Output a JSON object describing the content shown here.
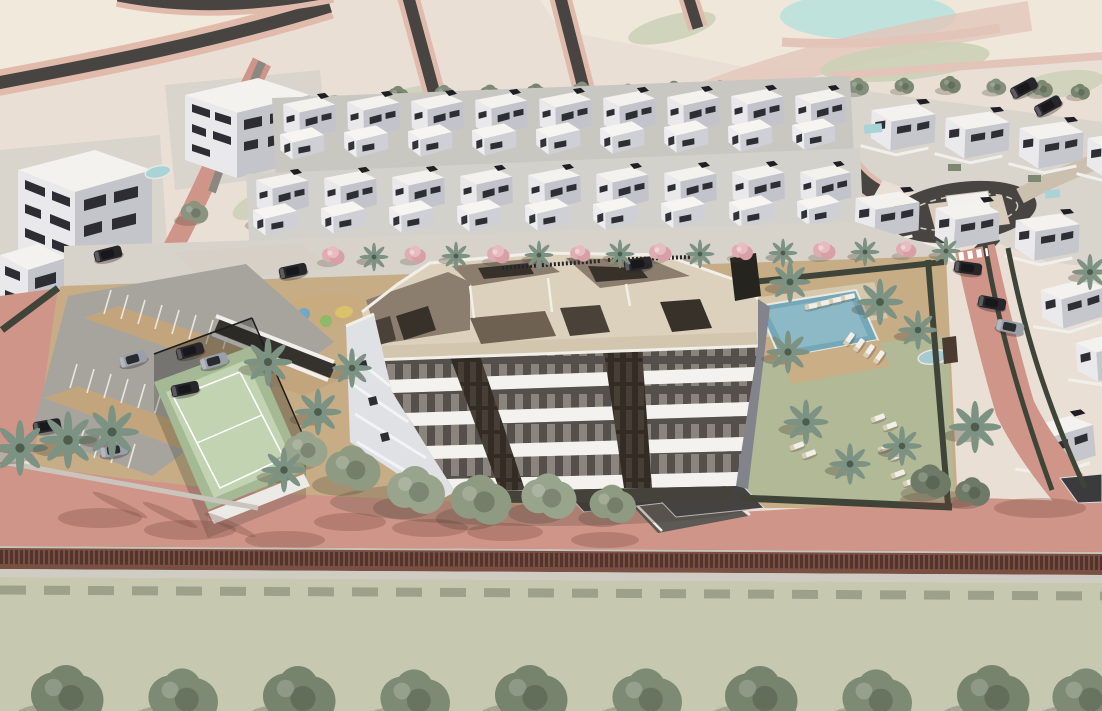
{
  "scene": {
    "type": "architectural-aerial-render",
    "description": "Aerial 3D visualization of a residential development: a central five-storey apartment building with rooftop terraces, surrounded by rows of white townhouses and villas, a communal pool garden with palm trees and sun loungers, a paddle-tennis court, a playground, a surface parking lot with cars, perimeter roads, a roundabout with a monument, farmland in the background and a green field with a row of trees in the foreground.",
    "areas": [
      {
        "name": "background-farmland",
        "label": "terraced farmland with rural roads"
      },
      {
        "name": "townhouse-rows",
        "label": "two rows of white townhouses"
      },
      {
        "name": "villa-cluster",
        "label": "detached villas with private pools"
      },
      {
        "name": "roundabout",
        "label": "roundabout with white monument block"
      },
      {
        "name": "main-building",
        "label": "five-storey apartment block with roof terraces"
      },
      {
        "name": "pool-garden",
        "label": "communal pool, deck and lawn with loungers"
      },
      {
        "name": "tennis-court",
        "label": "fenced paddle court"
      },
      {
        "name": "playground",
        "label": "children playground with colored circles"
      },
      {
        "name": "parking-lot",
        "label": "surface parking with cars"
      },
      {
        "name": "front-road",
        "label": "salmon perimeter road"
      },
      {
        "name": "front-field",
        "label": "green field with tree row"
      }
    ]
  },
  "colors": {
    "field_beige": "#e9dfd5",
    "field_cream": "#f2e9dd",
    "field_pink": "#e3c4b8",
    "field_sage": "#cbd0b6",
    "water": "#bfe2dc",
    "road_dark": "#474441",
    "road_gray": "#8b8781",
    "salmon": "#cf9588",
    "salmon_light": "#e0bbac",
    "sidewalk": "#d8d3ca",
    "cobble": "#d6d0c6",
    "ground_tan": "#c6ad86",
    "aisle_tan": "#c2a57c",
    "parking_gray": "#a7a49e",
    "bottom_field": "#c6c9b0",
    "wall_brown": "#7a4f44",
    "coping": "#cfccc4",
    "paving_pale": "#d9d5cd",
    "lawn": "#b2b996",
    "court": "#c1d3b1",
    "court_border": "#a5b995",
    "pool": "#74a7b8",
    "pool_light": "#a6cad2",
    "deck": "#c9ae86",
    "white_hi": "#f3f2ef",
    "white_lo": "#e9e9ec",
    "gray_side": "#c4c5cb",
    "gray_side2": "#9b9ca4",
    "win": "#2d2d33",
    "roof_beige": "#dcd1bc",
    "roof_beige2": "#d2c6ae",
    "taupe": "#8b7e6f",
    "taupe_dark": "#6e6152",
    "brown_core": "#38312a",
    "win_row_bg": "#55504b",
    "win_slit": "#8a847c",
    "core_bg": "#332c25",
    "core_slit": "#473f36",
    "hedge": "#3e4438",
    "tree": "#8a9480",
    "tree_light": "#99a48c",
    "tree_dark": "#707d67",
    "palm": "#7c9282",
    "pink": "#dfacb0",
    "car_dark": "#26262b",
    "car_silver": "#9aa0a8",
    "lounger": "#f1efe8",
    "plinth": "#45413b",
    "side_face": "#83838b",
    "band1": "#c9c7c2",
    "band2": "#d3d1cc",
    "driveway": "#5d5954",
    "pergola": "#3b3b3d"
  },
  "instances": [
    {
      "l": "otrees",
      "t": "tree",
      "x": 398,
      "y": 96,
      "s": 0.72,
      "c": "#7c8872"
    },
    {
      "l": "otrees",
      "t": "tree",
      "x": 444,
      "y": 94,
      "s": 0.66,
      "c": "#83907b"
    },
    {
      "l": "otrees",
      "t": "tree",
      "x": 490,
      "y": 95,
      "s": 0.74,
      "c": "#7c8872"
    },
    {
      "l": "otrees",
      "t": "tree",
      "x": 536,
      "y": 93,
      "s": 0.68,
      "c": "#76836d"
    },
    {
      "l": "otrees",
      "t": "tree",
      "x": 582,
      "y": 92,
      "s": 0.75,
      "c": "#83907b"
    },
    {
      "l": "otrees",
      "t": "tree",
      "x": 628,
      "y": 93,
      "s": 0.67,
      "c": "#7c8872"
    },
    {
      "l": "otrees",
      "t": "tree",
      "x": 674,
      "y": 91,
      "s": 0.73,
      "c": "#76836d"
    },
    {
      "l": "otrees",
      "t": "tree",
      "x": 720,
      "y": 90,
      "s": 0.69,
      "c": "#83907b"
    },
    {
      "l": "otrees",
      "t": "tree",
      "x": 766,
      "y": 91,
      "s": 0.74,
      "c": "#7c8872"
    },
    {
      "l": "otrees",
      "t": "tree",
      "x": 812,
      "y": 89,
      "s": 0.68,
      "c": "#76836d"
    },
    {
      "l": "otrees",
      "t": "tree",
      "x": 858,
      "y": 88,
      "s": 0.73,
      "c": "#83907b"
    },
    {
      "l": "otrees",
      "t": "tree",
      "x": 904,
      "y": 87,
      "s": 0.67,
      "c": "#7c8872"
    },
    {
      "l": "otrees",
      "t": "tree",
      "x": 950,
      "y": 86,
      "s": 0.72,
      "c": "#76836d"
    },
    {
      "l": "otrees",
      "t": "tree",
      "x": 996,
      "y": 88,
      "s": 0.68,
      "c": "#83907b"
    },
    {
      "l": "otrees",
      "t": "tree",
      "x": 1042,
      "y": 90,
      "s": 0.72,
      "c": "#7c8872"
    },
    {
      "l": "otrees",
      "t": "tree",
      "x": 1080,
      "y": 93,
      "s": 0.66,
      "c": "#76836d"
    },
    {
      "l": "floraL",
      "t": "tree",
      "x": 335,
      "y": 114,
      "s": 1.35,
      "c": "#8a9480",
      "n": "tree"
    },
    {
      "l": "floraL",
      "t": "tree",
      "x": 268,
      "y": 218,
      "s": 1.1,
      "c": "#7f8a76",
      "n": "tree"
    },
    {
      "l": "floraL",
      "t": "tree",
      "x": 194,
      "y": 214,
      "s": 0.95,
      "c": "#8a9480",
      "n": "tree"
    },
    {
      "l": "flora",
      "t": "pink",
      "x": 333,
      "y": 257,
      "s": 1.0,
      "n": "flowering-tree"
    },
    {
      "l": "flora",
      "t": "pink",
      "x": 415,
      "y": 256,
      "s": 0.95,
      "n": "flowering-tree"
    },
    {
      "l": "flora",
      "t": "pink",
      "x": 498,
      "y": 256,
      "s": 1.0,
      "n": "flowering-tree"
    },
    {
      "l": "flora",
      "t": "pink",
      "x": 580,
      "y": 255,
      "s": 0.9,
      "n": "flowering-tree"
    },
    {
      "l": "flora",
      "t": "pink",
      "x": 660,
      "y": 254,
      "s": 1.0,
      "n": "flowering-tree"
    },
    {
      "l": "flora",
      "t": "pink",
      "x": 742,
      "y": 253,
      "s": 0.95,
      "n": "flowering-tree"
    },
    {
      "l": "flora",
      "t": "pink",
      "x": 824,
      "y": 252,
      "s": 1.0,
      "n": "flowering-tree"
    },
    {
      "l": "flora",
      "t": "pink",
      "x": 906,
      "y": 251,
      "s": 0.9,
      "n": "flowering-tree"
    },
    {
      "l": "flora",
      "t": "palm",
      "x": 374,
      "y": 257,
      "s": 0.8,
      "n": "palm-tree"
    },
    {
      "l": "flora",
      "t": "palm",
      "x": 456,
      "y": 256,
      "s": 0.8,
      "n": "palm-tree"
    },
    {
      "l": "flora",
      "t": "palm",
      "x": 539,
      "y": 255,
      "s": 0.8,
      "n": "palm-tree"
    },
    {
      "l": "flora",
      "t": "palm",
      "x": 620,
      "y": 254,
      "s": 0.8,
      "n": "palm-tree"
    },
    {
      "l": "flora",
      "t": "palm",
      "x": 700,
      "y": 254,
      "s": 0.8,
      "n": "palm-tree"
    },
    {
      "l": "flora",
      "t": "palm",
      "x": 783,
      "y": 253,
      "s": 0.8,
      "n": "palm-tree"
    },
    {
      "l": "flora",
      "t": "palm",
      "x": 865,
      "y": 252,
      "s": 0.8,
      "n": "palm-tree"
    },
    {
      "l": "flora",
      "t": "palm",
      "x": 946,
      "y": 251,
      "s": 0.8,
      "n": "palm-tree"
    },
    {
      "l": "flora",
      "t": "tree",
      "x": 305,
      "y": 452,
      "s": 1.5,
      "c": "#99a48c",
      "n": "tree"
    },
    {
      "l": "flora",
      "t": "tree",
      "x": 352,
      "y": 472,
      "s": 1.9,
      "c": "#8e9a81",
      "n": "tree"
    },
    {
      "l": "flora",
      "t": "tree",
      "x": 415,
      "y": 494,
      "s": 2.0,
      "c": "#99a48c",
      "n": "tree"
    },
    {
      "l": "flora",
      "t": "tree",
      "x": 480,
      "y": 504,
      "s": 2.1,
      "c": "#8e9a81",
      "n": "tree"
    },
    {
      "l": "flora",
      "t": "tree",
      "x": 548,
      "y": 500,
      "s": 1.9,
      "c": "#99a48c",
      "n": "tree"
    },
    {
      "l": "flora",
      "t": "tree",
      "x": 612,
      "y": 507,
      "s": 1.6,
      "c": "#8e9a81",
      "n": "tree"
    },
    {
      "l": "flora",
      "t": "tree",
      "x": 930,
      "y": 484,
      "s": 1.4,
      "c": "#6e7a66",
      "n": "tree"
    },
    {
      "l": "flora",
      "t": "tree",
      "x": 972,
      "y": 494,
      "s": 1.2,
      "c": "#6e7a66",
      "n": "tree"
    },
    {
      "l": "flora",
      "t": "palm",
      "x": 20,
      "y": 448,
      "s": 1.55,
      "n": "palm-tree"
    },
    {
      "l": "flora",
      "t": "palm",
      "x": 68,
      "y": 440,
      "s": 1.6,
      "n": "palm-tree"
    },
    {
      "l": "flora",
      "t": "palm",
      "x": 112,
      "y": 432,
      "s": 1.5,
      "n": "palm-tree"
    },
    {
      "l": "flora",
      "t": "palm",
      "x": 268,
      "y": 362,
      "s": 1.35,
      "n": "palm-tree"
    },
    {
      "l": "flora",
      "t": "palm",
      "x": 318,
      "y": 412,
      "s": 1.3,
      "n": "palm-tree"
    },
    {
      "l": "flora",
      "t": "palm",
      "x": 284,
      "y": 470,
      "s": 1.25,
      "n": "palm-tree"
    },
    {
      "l": "flora",
      "t": "palm",
      "x": 352,
      "y": 368,
      "s": 1.1,
      "n": "palm-tree"
    },
    {
      "l": "flora",
      "t": "palm",
      "x": 790,
      "y": 282,
      "s": 1.15,
      "n": "palm-tree"
    },
    {
      "l": "flora",
      "t": "palm",
      "x": 880,
      "y": 302,
      "s": 1.3,
      "n": "palm-tree"
    },
    {
      "l": "flora",
      "t": "palm",
      "x": 918,
      "y": 330,
      "s": 1.1,
      "n": "palm-tree"
    },
    {
      "l": "flora",
      "t": "palm",
      "x": 788,
      "y": 352,
      "s": 1.2,
      "n": "palm-tree"
    },
    {
      "l": "flora",
      "t": "palm",
      "x": 806,
      "y": 422,
      "s": 1.25,
      "n": "palm-tree"
    },
    {
      "l": "flora",
      "t": "palm",
      "x": 850,
      "y": 464,
      "s": 1.15,
      "n": "palm-tree"
    },
    {
      "l": "flora",
      "t": "palm",
      "x": 902,
      "y": 446,
      "s": 1.1,
      "n": "palm-tree"
    },
    {
      "l": "flora",
      "t": "palm",
      "x": 975,
      "y": 427,
      "s": 1.45,
      "n": "palm-tree"
    },
    {
      "l": "flora",
      "t": "palm",
      "x": 1090,
      "y": 272,
      "s": 1.0,
      "n": "palm-tree"
    },
    {
      "l": "objects",
      "t": "car",
      "x": 108,
      "y": 254,
      "r": -14,
      "c": "#26262b",
      "n": "car"
    },
    {
      "l": "objects",
      "t": "car",
      "x": 293,
      "y": 271,
      "r": -12,
      "c": "#26262b",
      "n": "car"
    },
    {
      "l": "objects",
      "t": "car",
      "x": 638,
      "y": 264,
      "r": -8,
      "c": "#26262b",
      "n": "car"
    },
    {
      "l": "objects",
      "t": "car",
      "x": 190,
      "y": 351,
      "r": -16,
      "c": "#26262b",
      "n": "car"
    },
    {
      "l": "objects",
      "t": "car",
      "x": 214,
      "y": 361,
      "r": -16,
      "c": "#9aa0a8",
      "n": "car"
    },
    {
      "l": "objects",
      "t": "car",
      "x": 133,
      "y": 359,
      "r": -16,
      "c": "#9aa0a8",
      "n": "car"
    },
    {
      "l": "objects",
      "t": "car",
      "x": 185,
      "y": 389,
      "r": -12,
      "c": "#26262b",
      "n": "car"
    },
    {
      "l": "objects",
      "t": "car",
      "x": 47,
      "y": 426,
      "r": -10,
      "c": "#26262b",
      "n": "car"
    },
    {
      "l": "objects",
      "t": "car",
      "x": 114,
      "y": 450,
      "r": -10,
      "c": "#9aa0a8",
      "n": "car"
    },
    {
      "l": "objects",
      "t": "car",
      "x": 968,
      "y": 268,
      "r": 8,
      "c": "#26262b",
      "n": "car"
    },
    {
      "l": "objects",
      "t": "car",
      "x": 992,
      "y": 303,
      "r": 10,
      "c": "#26262b",
      "n": "car"
    },
    {
      "l": "objects",
      "t": "car",
      "x": 1010,
      "y": 327,
      "r": 12,
      "c": "#9aa0a8",
      "n": "car"
    },
    {
      "l": "objects",
      "t": "car",
      "x": 1024,
      "y": 88,
      "r": -28,
      "c": "#26262b",
      "n": "car"
    },
    {
      "l": "objects",
      "t": "car",
      "x": 1048,
      "y": 106,
      "r": -28,
      "c": "#26262b",
      "n": "car"
    },
    {
      "l": "objects",
      "t": "lounger",
      "x": 812,
      "y": 306,
      "r": -12,
      "n": "sun-lounger"
    },
    {
      "l": "objects",
      "t": "lounger",
      "x": 824,
      "y": 303,
      "r": -12,
      "n": "sun-lounger"
    },
    {
      "l": "objects",
      "t": "lounger",
      "x": 836,
      "y": 300,
      "r": -12,
      "n": "sun-lounger"
    },
    {
      "l": "objects",
      "t": "lounger",
      "x": 848,
      "y": 297,
      "r": -12,
      "n": "sun-lounger"
    },
    {
      "l": "objects",
      "t": "lounger",
      "x": 849,
      "y": 339,
      "r": -55,
      "n": "sun-lounger"
    },
    {
      "l": "objects",
      "t": "lounger",
      "x": 859,
      "y": 345,
      "r": -55,
      "n": "sun-lounger"
    },
    {
      "l": "objects",
      "t": "lounger",
      "x": 869,
      "y": 351,
      "r": -55,
      "n": "sun-lounger"
    },
    {
      "l": "objects",
      "t": "lounger",
      "x": 879,
      "y": 357,
      "r": -55,
      "n": "sun-lounger"
    },
    {
      "l": "objects",
      "t": "lounger",
      "x": 878,
      "y": 418,
      "r": -20,
      "n": "sun-lounger"
    },
    {
      "l": "objects",
      "t": "lounger",
      "x": 890,
      "y": 426,
      "r": -20,
      "n": "sun-lounger"
    },
    {
      "l": "objects",
      "t": "lounger",
      "x": 885,
      "y": 448,
      "r": -20,
      "n": "sun-lounger"
    },
    {
      "l": "objects",
      "t": "lounger",
      "x": 897,
      "y": 456,
      "r": -20,
      "n": "sun-lounger"
    },
    {
      "l": "objects",
      "t": "lounger",
      "x": 898,
      "y": 474,
      "r": -20,
      "n": "sun-lounger"
    },
    {
      "l": "objects",
      "t": "lounger",
      "x": 910,
      "y": 482,
      "r": -20,
      "n": "sun-lounger"
    },
    {
      "l": "objects",
      "t": "lounger",
      "x": 797,
      "y": 446,
      "r": -20,
      "n": "sun-lounger"
    },
    {
      "l": "objects",
      "t": "lounger",
      "x": 809,
      "y": 454,
      "r": -20,
      "n": "sun-lounger"
    },
    {
      "l": "units",
      "t": "th",
      "x": 283,
      "y": 98,
      "r": -1.5,
      "n": "townhouse"
    },
    {
      "l": "units",
      "t": "th",
      "x": 347,
      "y": 96,
      "r": -1.5,
      "n": "townhouse"
    },
    {
      "l": "units",
      "t": "th",
      "x": 411,
      "y": 95,
      "r": -1.5,
      "n": "townhouse"
    },
    {
      "l": "units",
      "t": "th",
      "x": 475,
      "y": 94,
      "r": -1.5,
      "n": "townhouse"
    },
    {
      "l": "units",
      "t": "th",
      "x": 539,
      "y": 93,
      "r": -1.5,
      "n": "townhouse"
    },
    {
      "l": "units",
      "t": "th",
      "x": 603,
      "y": 92,
      "r": -1.5,
      "n": "townhouse"
    },
    {
      "l": "units",
      "t": "th",
      "x": 667,
      "y": 91,
      "r": -1.5,
      "n": "townhouse"
    },
    {
      "l": "units",
      "t": "th",
      "x": 731,
      "y": 90,
      "r": -1.5,
      "n": "townhouse"
    },
    {
      "l": "units",
      "t": "th",
      "x": 795,
      "y": 90,
      "r": -1.5,
      "s": 0.97,
      "n": "townhouse"
    },
    {
      "l": "units",
      "t": "th",
      "x": 256,
      "y": 174,
      "r": -1.5,
      "n": "townhouse"
    },
    {
      "l": "units",
      "t": "th",
      "x": 324,
      "y": 172,
      "r": -1.5,
      "n": "townhouse"
    },
    {
      "l": "units",
      "t": "th",
      "x": 392,
      "y": 171,
      "r": -1.5,
      "n": "townhouse"
    },
    {
      "l": "units",
      "t": "th",
      "x": 460,
      "y": 170,
      "r": -1.5,
      "n": "townhouse"
    },
    {
      "l": "units",
      "t": "th",
      "x": 528,
      "y": 169,
      "r": -1.5,
      "n": "townhouse"
    },
    {
      "l": "units",
      "t": "th",
      "x": 596,
      "y": 168,
      "r": -1.5,
      "n": "townhouse"
    },
    {
      "l": "units",
      "t": "th",
      "x": 664,
      "y": 167,
      "r": -1.5,
      "n": "townhouse"
    },
    {
      "l": "units",
      "t": "th",
      "x": 732,
      "y": 166,
      "r": -1.5,
      "n": "townhouse"
    },
    {
      "l": "units",
      "t": "th",
      "x": 800,
      "y": 166,
      "r": -1.5,
      "s": 0.97,
      "n": "townhouse"
    },
    {
      "l": "units",
      "t": "villa",
      "x": 872,
      "y": 102,
      "r": 2,
      "n": "villa"
    },
    {
      "l": "units",
      "t": "villa",
      "x": 946,
      "y": 110,
      "r": 2,
      "n": "villa"
    },
    {
      "l": "units",
      "t": "villa",
      "x": 1020,
      "y": 120,
      "r": 2,
      "n": "villa"
    },
    {
      "l": "units",
      "t": "villa",
      "x": 1088,
      "y": 130,
      "r": 2,
      "n": "villa"
    },
    {
      "l": "units",
      "t": "villa",
      "x": 856,
      "y": 190,
      "r": 2,
      "n": "villa"
    },
    {
      "l": "units",
      "t": "villa",
      "x": 936,
      "y": 200,
      "r": 2,
      "n": "villa"
    },
    {
      "l": "units",
      "t": "villa",
      "x": 1016,
      "y": 212,
      "r": 2,
      "n": "villa"
    },
    {
      "l": "units",
      "t": "villa",
      "x": 1040,
      "y": 282,
      "r": -4,
      "n": "villa"
    },
    {
      "l": "units",
      "t": "villa",
      "x": 1075,
      "y": 335,
      "r": -4,
      "n": "villa"
    },
    {
      "l": "units",
      "t": "villa",
      "x": 1022,
      "y": 420,
      "r": -5,
      "s": 1.1,
      "n": "villa"
    },
    {
      "l": "btrees",
      "t": "tree",
      "x": 66,
      "y": 700,
      "s": 2.5,
      "c": "#76836d",
      "n": "tree"
    },
    {
      "l": "btrees",
      "t": "tree",
      "x": 182,
      "y": 702,
      "s": 2.4,
      "c": "#7e8b74",
      "n": "tree"
    },
    {
      "l": "btrees",
      "t": "tree",
      "x": 298,
      "y": 701,
      "s": 2.5,
      "c": "#76836d",
      "n": "tree"
    },
    {
      "l": "btrees",
      "t": "tree",
      "x": 414,
      "y": 703,
      "s": 2.4,
      "c": "#7e8b74",
      "n": "tree"
    },
    {
      "l": "btrees",
      "t": "tree",
      "x": 530,
      "y": 700,
      "s": 2.5,
      "c": "#76836d",
      "n": "tree"
    },
    {
      "l": "btrees",
      "t": "tree",
      "x": 646,
      "y": 702,
      "s": 2.4,
      "c": "#7e8b74",
      "n": "tree"
    },
    {
      "l": "btrees",
      "t": "tree",
      "x": 760,
      "y": 701,
      "s": 2.5,
      "c": "#76836d",
      "n": "tree"
    },
    {
      "l": "btrees",
      "t": "tree",
      "x": 876,
      "y": 703,
      "s": 2.4,
      "c": "#7e8b74",
      "n": "tree"
    },
    {
      "l": "btrees",
      "t": "tree",
      "x": 992,
      "y": 700,
      "s": 2.5,
      "c": "#76836d",
      "n": "tree"
    },
    {
      "l": "btrees",
      "t": "tree",
      "x": 1086,
      "y": 702,
      "s": 2.4,
      "c": "#7e8b74",
      "n": "tree"
    }
  ]
}
